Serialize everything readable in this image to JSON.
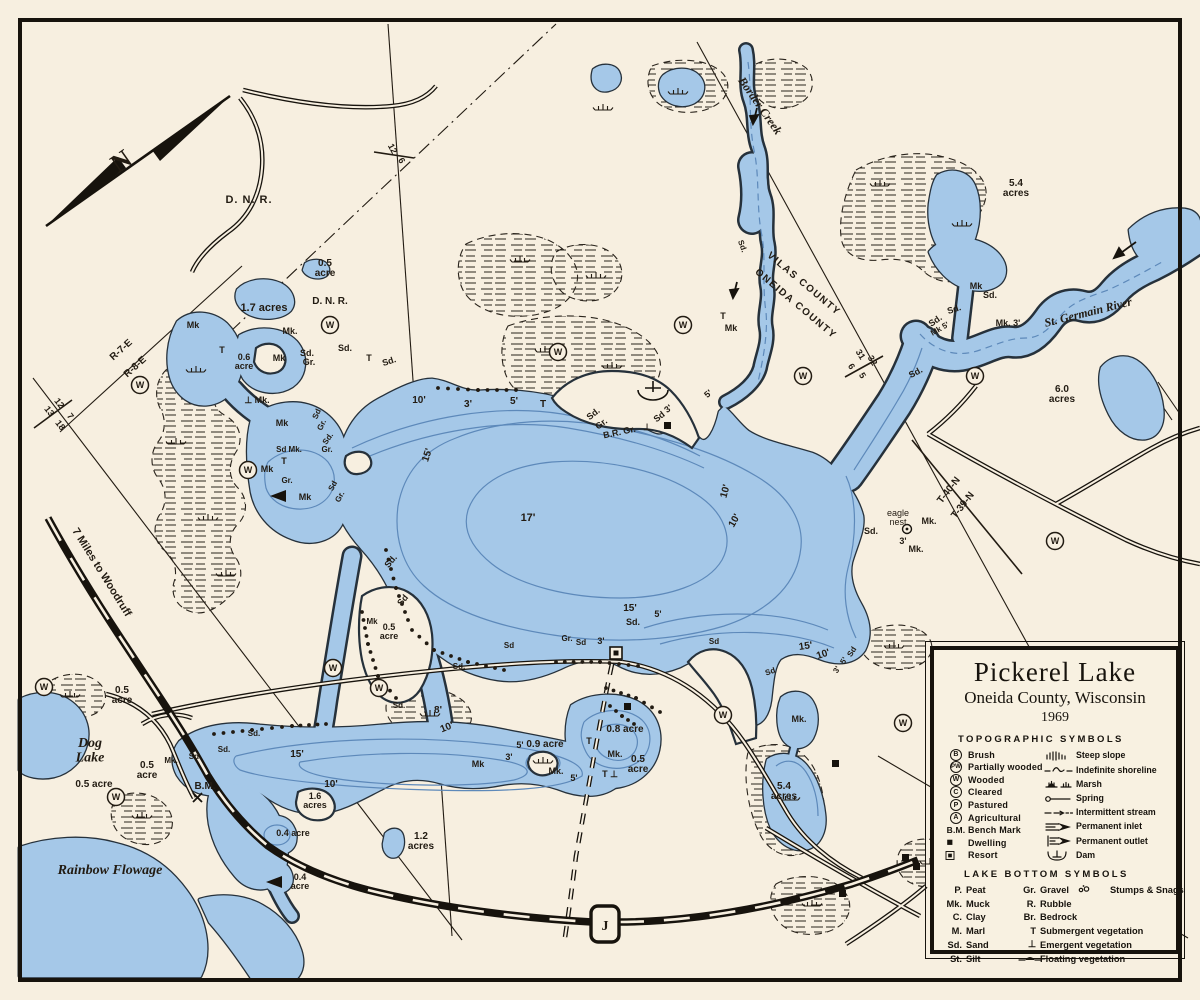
{
  "legend": {
    "title": "Pickerel Lake",
    "subtitle": "Oneida County, Wisconsin",
    "year": "1969",
    "topo_header": "TOPOGRAPHIC SYMBOLS",
    "topo_left": [
      {
        "sym": "B",
        "kind": "circle",
        "label": "Brush"
      },
      {
        "sym": "PW",
        "kind": "circle",
        "label": "Partially wooded"
      },
      {
        "sym": "W",
        "kind": "circle",
        "label": "Wooded"
      },
      {
        "sym": "C",
        "kind": "circle",
        "label": "Cleared"
      },
      {
        "sym": "P",
        "kind": "circle",
        "label": "Pastured"
      },
      {
        "sym": "A",
        "kind": "circle",
        "label": "Agricultural"
      },
      {
        "sym": "B.M.",
        "kind": "text",
        "label": "Bench Mark"
      },
      {
        "sym": "dwelling",
        "kind": "icon",
        "label": "Dwelling"
      },
      {
        "sym": "resort",
        "kind": "icon",
        "label": "Resort"
      }
    ],
    "topo_right": [
      {
        "sym": "steep",
        "label": "Steep slope"
      },
      {
        "sym": "indef",
        "label": "Indefinite shoreline"
      },
      {
        "sym": "marsh",
        "label": "Marsh"
      },
      {
        "sym": "spring",
        "label": "Spring"
      },
      {
        "sym": "intermit",
        "label": "Intermittent stream"
      },
      {
        "sym": "inlet",
        "label": "Permanent inlet"
      },
      {
        "sym": "outlet",
        "label": "Permanent outlet"
      },
      {
        "sym": "dam",
        "label": "Dam"
      }
    ],
    "bottom_header": "LAKE BOTTOM SYMBOLS",
    "bottom_left": [
      {
        "sym": "P.",
        "label": "Peat"
      },
      {
        "sym": "Mk.",
        "label": "Muck"
      },
      {
        "sym": "C.",
        "label": "Clay"
      },
      {
        "sym": "M.",
        "label": "Marl"
      },
      {
        "sym": "Sd.",
        "label": "Sand"
      },
      {
        "sym": "St.",
        "label": "Silt"
      }
    ],
    "bottom_right": [
      {
        "sym": "Gr.",
        "label": "Gravel",
        "extra_sym": "stumps",
        "extra_label": "Stumps & Snags"
      },
      {
        "sym": "R.",
        "label": "Rubble"
      },
      {
        "sym": "Br.",
        "label": "Bedrock"
      },
      {
        "sym": "T",
        "label": "Submergent vegetation"
      },
      {
        "sym": "⊥",
        "label": "Emergent vegetation"
      },
      {
        "sym": "float",
        "label": "Floating vegetation",
        "icon": true
      }
    ]
  },
  "map": {
    "w_symbol": "W",
    "colors": {
      "paper": "#f7efe0",
      "water": "#a5c8e8",
      "shore": "#26313b",
      "ink": "#221b12",
      "contour": "#5d89ba"
    },
    "w_circles": [
      [
        330,
        325
      ],
      [
        558,
        352
      ],
      [
        683,
        325
      ],
      [
        803,
        376
      ],
      [
        975,
        376
      ],
      [
        1055,
        541
      ],
      [
        723,
        715
      ],
      [
        903,
        723
      ],
      [
        140,
        385
      ],
      [
        248,
        470
      ],
      [
        116,
        797
      ],
      [
        44,
        687
      ],
      [
        333,
        668
      ],
      [
        379,
        688
      ]
    ],
    "labels": [
      {
        "t": "N",
        "x": 126,
        "y": 168,
        "s": 26,
        "r": -35,
        "st": "se"
      },
      {
        "t": "D. N. R.",
        "x": 249,
        "y": 203,
        "s": 11,
        "ls": 1
      },
      {
        "t": "D. N. R.",
        "x": 330,
        "y": 304,
        "s": 10
      },
      {
        "t": "0.5\nacre",
        "x": 325,
        "y": 266,
        "s": 10
      },
      {
        "t": "1.7 acres",
        "x": 264,
        "y": 311,
        "s": 11
      },
      {
        "t": "Border Creek",
        "x": 757,
        "y": 108,
        "s": 12,
        "r": 55,
        "st": "i"
      },
      {
        "t": "VILAS COUNTY",
        "x": 802,
        "y": 286,
        "s": 10,
        "r": 40,
        "ls": 1.5
      },
      {
        "t": "ONEIDA COUNTY",
        "x": 794,
        "y": 306,
        "s": 10,
        "r": 40,
        "ls": 1.5
      },
      {
        "t": "31",
        "x": 858,
        "y": 356,
        "s": 9,
        "r": 58
      },
      {
        "t": "32",
        "x": 870,
        "y": 362,
        "s": 9,
        "r": 58
      },
      {
        "t": "6",
        "x": 849,
        "y": 368,
        "s": 9,
        "r": 58
      },
      {
        "t": "5",
        "x": 860,
        "y": 377,
        "s": 9,
        "r": 58
      },
      {
        "t": "5.4\nacres",
        "x": 1016,
        "y": 186,
        "s": 10
      },
      {
        "t": "St. Germain River",
        "x": 1089,
        "y": 316,
        "s": 12,
        "r": -14,
        "st": "i"
      },
      {
        "t": "6.0\nacres",
        "x": 1062,
        "y": 392,
        "s": 10
      },
      {
        "t": "R-7-E",
        "x": 123,
        "y": 352,
        "s": 10,
        "r": -42
      },
      {
        "t": "R-8-E",
        "x": 137,
        "y": 369,
        "s": 10,
        "r": -42
      },
      {
        "t": "12",
        "x": 57,
        "y": 405,
        "s": 9,
        "r": 52
      },
      {
        "t": "7",
        "x": 68,
        "y": 418,
        "s": 9,
        "r": 52
      },
      {
        "t": "13",
        "x": 47,
        "y": 413,
        "s": 9,
        "r": 52
      },
      {
        "t": "18",
        "x": 58,
        "y": 427,
        "s": 9,
        "r": 52
      },
      {
        "t": "12",
        "x": 390,
        "y": 150,
        "s": 9,
        "r": 62
      },
      {
        "t": "6",
        "x": 399,
        "y": 162,
        "s": 9,
        "r": 62
      },
      {
        "t": "7 Miles to Woodruff",
        "x": 99,
        "y": 574,
        "s": 11,
        "r": 58
      },
      {
        "t": "Dog\nLake",
        "x": 90,
        "y": 747,
        "s": 14,
        "st": "i"
      },
      {
        "t": "Rainbow Flowage",
        "x": 110,
        "y": 874,
        "s": 14,
        "st": "i"
      },
      {
        "t": "0.5\nacre",
        "x": 122,
        "y": 693,
        "s": 10
      },
      {
        "t": "0.5 acre",
        "x": 94,
        "y": 787,
        "s": 10
      },
      {
        "t": "0.5\nacre",
        "x": 147,
        "y": 768,
        "s": 10
      },
      {
        "t": "B.M.",
        "x": 205,
        "y": 789,
        "s": 10
      },
      {
        "t": "1.6\nacres",
        "x": 315,
        "y": 799,
        "s": 9
      },
      {
        "t": "0.4 acre",
        "x": 293,
        "y": 836,
        "s": 9
      },
      {
        "t": "0.4\nacre",
        "x": 300,
        "y": 880,
        "s": 9
      },
      {
        "t": "1.2\nacres",
        "x": 421,
        "y": 839,
        "s": 10
      },
      {
        "t": "0.9 acre",
        "x": 545,
        "y": 747,
        "s": 10
      },
      {
        "t": "0.8 acre",
        "x": 625,
        "y": 732,
        "s": 10
      },
      {
        "t": "0.5\nacre",
        "x": 638,
        "y": 762,
        "s": 10
      },
      {
        "t": "5.4\nacres",
        "x": 784,
        "y": 789,
        "s": 10
      },
      {
        "t": "17'",
        "x": 528,
        "y": 521,
        "s": 11
      },
      {
        "t": "15'",
        "x": 430,
        "y": 456,
        "s": 10,
        "r": -72
      },
      {
        "t": "10'",
        "x": 419,
        "y": 403,
        "s": 10
      },
      {
        "t": "3'",
        "x": 468,
        "y": 407,
        "s": 10
      },
      {
        "t": "5'",
        "x": 514,
        "y": 404,
        "s": 10
      },
      {
        "t": "T",
        "x": 543,
        "y": 407,
        "s": 10
      },
      {
        "t": "15'",
        "x": 630,
        "y": 611,
        "s": 10
      },
      {
        "t": "5'",
        "x": 658,
        "y": 617,
        "s": 9
      },
      {
        "t": "Sd.",
        "x": 633,
        "y": 625,
        "s": 9
      },
      {
        "t": "15'",
        "x": 806,
        "y": 649,
        "s": 10,
        "r": -8
      },
      {
        "t": "10'",
        "x": 824,
        "y": 657,
        "s": 10,
        "r": -18
      },
      {
        "t": "10'",
        "x": 728,
        "y": 492,
        "s": 10,
        "r": -75
      },
      {
        "t": "10'",
        "x": 737,
        "y": 522,
        "s": 10,
        "r": -60
      },
      {
        "t": "5'",
        "x": 710,
        "y": 396,
        "s": 9,
        "r": -40
      },
      {
        "t": "8'",
        "x": 438,
        "y": 713,
        "s": 10
      },
      {
        "t": "10'",
        "x": 448,
        "y": 730,
        "s": 10,
        "r": -22
      },
      {
        "t": "15'",
        "x": 297,
        "y": 757,
        "s": 10
      },
      {
        "t": "10'",
        "x": 331,
        "y": 787,
        "s": 10
      },
      {
        "t": "5'",
        "x": 520,
        "y": 748,
        "s": 9
      },
      {
        "t": "3'",
        "x": 509,
        "y": 760,
        "s": 9
      },
      {
        "t": "Mk",
        "x": 478,
        "y": 767,
        "s": 9
      },
      {
        "t": "Mk.",
        "x": 556,
        "y": 774,
        "s": 9
      },
      {
        "t": "5'",
        "x": 574,
        "y": 781,
        "s": 9
      },
      {
        "t": "T ⊥",
        "x": 610,
        "y": 777,
        "s": 9
      },
      {
        "t": "T",
        "x": 589,
        "y": 744,
        "s": 9
      },
      {
        "t": "Mk.",
        "x": 615,
        "y": 757,
        "s": 9
      },
      {
        "t": "Sd.",
        "x": 393,
        "y": 563,
        "s": 9,
        "r": -50
      },
      {
        "t": "Sd",
        "x": 405,
        "y": 602,
        "s": 9,
        "r": -50
      },
      {
        "t": "Sd.",
        "x": 595,
        "y": 416,
        "s": 9,
        "r": -38
      },
      {
        "t": "Gr.",
        "x": 603,
        "y": 426,
        "s": 9,
        "r": -38
      },
      {
        "t": "B.R. Gr.",
        "x": 620,
        "y": 435,
        "s": 9,
        "r": -12
      },
      {
        "t": "⊥",
        "x": 647,
        "y": 430,
        "s": 9
      },
      {
        "t": "Sd",
        "x": 661,
        "y": 419,
        "s": 9,
        "r": -38
      },
      {
        "t": "3'",
        "x": 670,
        "y": 411,
        "s": 9,
        "r": -38
      },
      {
        "t": "eagle\nnest",
        "x": 898,
        "y": 516,
        "s": 9,
        "st": "n"
      },
      {
        "t": "Mk.",
        "x": 929,
        "y": 524,
        "s": 9
      },
      {
        "t": "Sd.",
        "x": 871,
        "y": 534,
        "s": 9
      },
      {
        "t": "3'",
        "x": 903,
        "y": 544,
        "s": 9
      },
      {
        "t": "Mk.",
        "x": 916,
        "y": 552,
        "s": 9
      },
      {
        "t": "T-40-N",
        "x": 951,
        "y": 492,
        "s": 10,
        "r": -52
      },
      {
        "t": "T-39-N",
        "x": 965,
        "y": 507,
        "s": 10,
        "r": -52
      },
      {
        "t": "Mk",
        "x": 976,
        "y": 289,
        "s": 9
      },
      {
        "t": "Sd.",
        "x": 990,
        "y": 298,
        "s": 9
      },
      {
        "t": "Sd.",
        "x": 955,
        "y": 312,
        "s": 9,
        "r": -18
      },
      {
        "t": "Sd.",
        "x": 937,
        "y": 323,
        "s": 9,
        "r": -35
      },
      {
        "t": "Mk 5'",
        "x": 941,
        "y": 331,
        "s": 8,
        "r": -30
      },
      {
        "t": "Mk. 3'",
        "x": 1008,
        "y": 326,
        "s": 9
      },
      {
        "t": "Sd.",
        "x": 917,
        "y": 375,
        "s": 9,
        "r": -28
      },
      {
        "t": "Mk",
        "x": 193,
        "y": 328,
        "s": 9
      },
      {
        "t": "T",
        "x": 222,
        "y": 353,
        "s": 9
      },
      {
        "t": "0.6\nacre",
        "x": 244,
        "y": 360,
        "s": 9
      },
      {
        "t": "Mk.",
        "x": 290,
        "y": 334,
        "s": 9
      },
      {
        "t": "Mk",
        "x": 279,
        "y": 361,
        "s": 9
      },
      {
        "t": "Sd.",
        "x": 307,
        "y": 356,
        "s": 9
      },
      {
        "t": "Gr.",
        "x": 309,
        "y": 365,
        "s": 9
      },
      {
        "t": "⊥ Mk.",
        "x": 257,
        "y": 403,
        "s": 9
      },
      {
        "t": "Sd.",
        "x": 345,
        "y": 351,
        "s": 9
      },
      {
        "t": "T",
        "x": 369,
        "y": 361,
        "s": 9
      },
      {
        "t": "Sd.",
        "x": 390,
        "y": 364,
        "s": 9,
        "r": -18
      },
      {
        "t": "T",
        "x": 723,
        "y": 319,
        "s": 9
      },
      {
        "t": "Mk",
        "x": 731,
        "y": 331,
        "s": 9
      },
      {
        "t": "Sd",
        "x": 319,
        "y": 415,
        "s": 8,
        "r": -65
      },
      {
        "t": "Gr.",
        "x": 324,
        "y": 426,
        "s": 8,
        "r": -65
      },
      {
        "t": "Sd.",
        "x": 330,
        "y": 440,
        "s": 8,
        "r": -55
      },
      {
        "t": "Mk",
        "x": 282,
        "y": 426,
        "s": 9
      },
      {
        "t": "Sd Mk.",
        "x": 289,
        "y": 452,
        "s": 8
      },
      {
        "t": "Gr.",
        "x": 327,
        "y": 452,
        "s": 8
      },
      {
        "t": "T",
        "x": 284,
        "y": 464,
        "s": 9
      },
      {
        "t": "Mk",
        "x": 267,
        "y": 472,
        "s": 9
      },
      {
        "t": "Gr.",
        "x": 287,
        "y": 483,
        "s": 8
      },
      {
        "t": "Mk",
        "x": 305,
        "y": 500,
        "s": 9
      },
      {
        "t": "Sd",
        "x": 335,
        "y": 487,
        "s": 8,
        "r": -62
      },
      {
        "t": "Gr.",
        "x": 342,
        "y": 498,
        "s": 8,
        "r": -62
      },
      {
        "t": "0.5\nacre",
        "x": 389,
        "y": 630,
        "s": 9
      },
      {
        "t": "Mk",
        "x": 372,
        "y": 624,
        "s": 8
      },
      {
        "t": "Sd.",
        "x": 399,
        "y": 708,
        "s": 8
      },
      {
        "t": "Sd.",
        "x": 459,
        "y": 669,
        "s": 8
      },
      {
        "t": "Sd",
        "x": 509,
        "y": 648,
        "s": 8
      },
      {
        "t": "Gr.",
        "x": 567,
        "y": 641,
        "s": 8
      },
      {
        "t": "Sd",
        "x": 581,
        "y": 645,
        "s": 8
      },
      {
        "t": "3'",
        "x": 601,
        "y": 644,
        "s": 9
      },
      {
        "t": "Sd",
        "x": 714,
        "y": 644,
        "s": 8
      },
      {
        "t": "Sd",
        "x": 771,
        "y": 674,
        "s": 8,
        "r": -18
      },
      {
        "t": "Mk.",
        "x": 799,
        "y": 722,
        "s": 9
      },
      {
        "t": "3'",
        "x": 839,
        "y": 671,
        "s": 8,
        "r": -58
      },
      {
        "t": "5'",
        "x": 846,
        "y": 662,
        "s": 8,
        "r": -58
      },
      {
        "t": "Sd",
        "x": 854,
        "y": 653,
        "s": 8,
        "r": -58
      },
      {
        "t": "Mk.",
        "x": 171,
        "y": 763,
        "s": 8
      },
      {
        "t": "Sd.",
        "x": 195,
        "y": 759,
        "s": 8
      },
      {
        "t": "Sd.",
        "x": 224,
        "y": 752,
        "s": 8
      },
      {
        "t": "Sd.",
        "x": 254,
        "y": 736,
        "s": 8
      },
      {
        "t": "Sd.",
        "x": 740,
        "y": 247,
        "s": 8,
        "r": 70
      },
      {
        "t": "J",
        "x": 605,
        "y": 930,
        "s": 14,
        "st": "se"
      }
    ]
  }
}
